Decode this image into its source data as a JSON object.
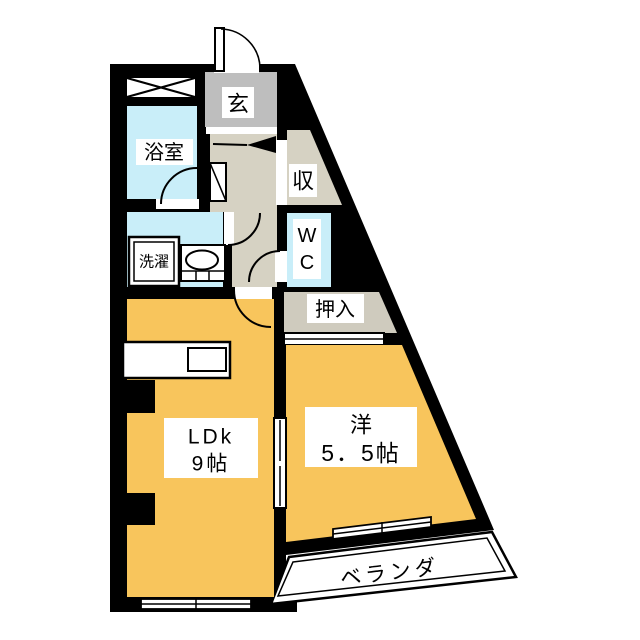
{
  "title": "間取り図",
  "rooms": {
    "entrance": {
      "label": "玄"
    },
    "bathroom": {
      "label": "浴室"
    },
    "laundry": {
      "label": "洗濯"
    },
    "toilet": {
      "line1": "W",
      "line2": "C"
    },
    "storage": {
      "label": "収"
    },
    "closet": {
      "label": "押入"
    },
    "ldk": {
      "name": "LDk",
      "size": "9帖"
    },
    "western_room": {
      "name": "洋",
      "size": "5．5帖"
    },
    "veranda": {
      "label": "ベランダ"
    }
  },
  "colors": {
    "wall": "#000000",
    "room": "#F8C55C",
    "wet_area": "#C9EEF9",
    "hallway": "#D6D2C3",
    "entrance_floor": "#BEBEBE",
    "closet": "#CFCBBE",
    "paper": "#FFFFFF"
  }
}
